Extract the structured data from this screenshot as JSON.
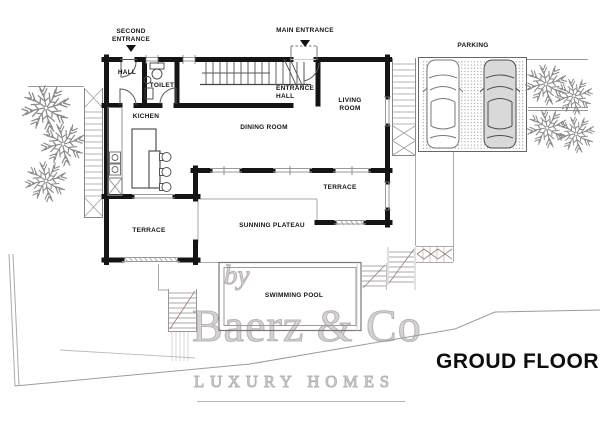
{
  "plan": {
    "labels": {
      "second_entrance": "SECOND\nENTRANCE",
      "main_entrance": "MAIN ENTRANCE",
      "hall": "HALL",
      "toilet": "TOILET",
      "entrance_hall": "ENTRANCE\nHALL",
      "living_room": "LIVING\nROOM",
      "kitchen": "KICHEN",
      "dining_room": "DINING ROOM",
      "terrace_right": "TERRACE",
      "sunning_plateau": "SUNNING PLATEAU",
      "terrace_left": "TERRACE",
      "swimming_pool": "SWIMMING POOL",
      "parking": "PARKING"
    }
  },
  "watermark": {
    "prefix": "by",
    "brand": "Baerz & Co",
    "tagline": "LUXURY HOMES"
  },
  "footer": {
    "title": "GROUD FLOOR"
  },
  "colors": {
    "wall": "#141414",
    "thin_line": "#999999",
    "stair_accent": "#a37a72",
    "watermark": "#b9b3b3",
    "label_text": "#151515"
  }
}
